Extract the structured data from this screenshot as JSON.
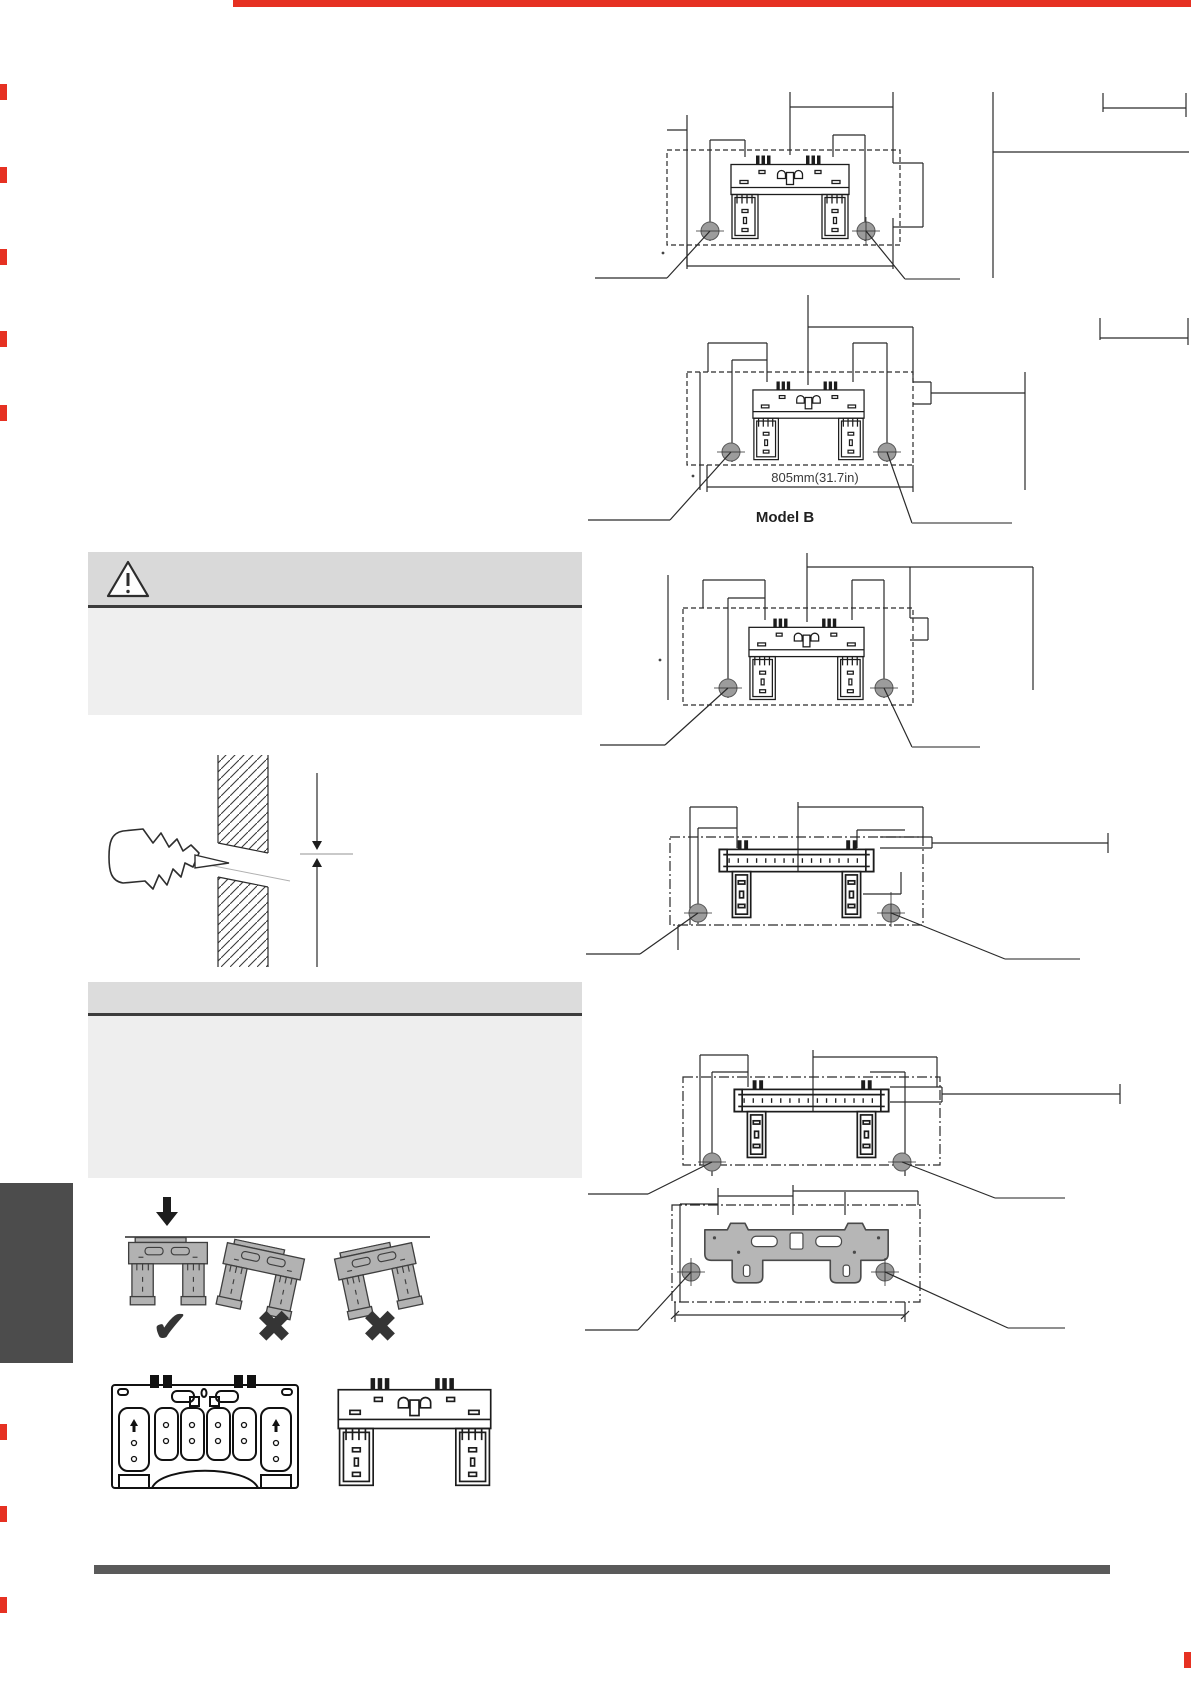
{
  "page": {
    "width": 1191,
    "height": 1684
  },
  "labels": {
    "model_b": "Model B",
    "dim_805": "805mm(31.7in)"
  },
  "marks": {
    "check": "✔",
    "cross_1": "✖",
    "cross_2": "✖"
  },
  "colors": {
    "accent_red": "#e63122",
    "line": "#2a2a2a",
    "plate_gray": "#b2b2b2",
    "hole_fill": "#9c9c9c",
    "caution_header": "#d9d9d9",
    "caution_body": "#efefef",
    "notice_header": "#dcdcdc",
    "notice_body": "#eeeeee",
    "separator": "#3c3c3c",
    "side_tab": "#4c4c4c",
    "footer_bar": "#5a5a5a"
  },
  "icons": {
    "caution_icon": "warning-triangle-icon",
    "correct_icon": "check-mark-icon",
    "incorrect_icon": "cross-mark-icon"
  }
}
